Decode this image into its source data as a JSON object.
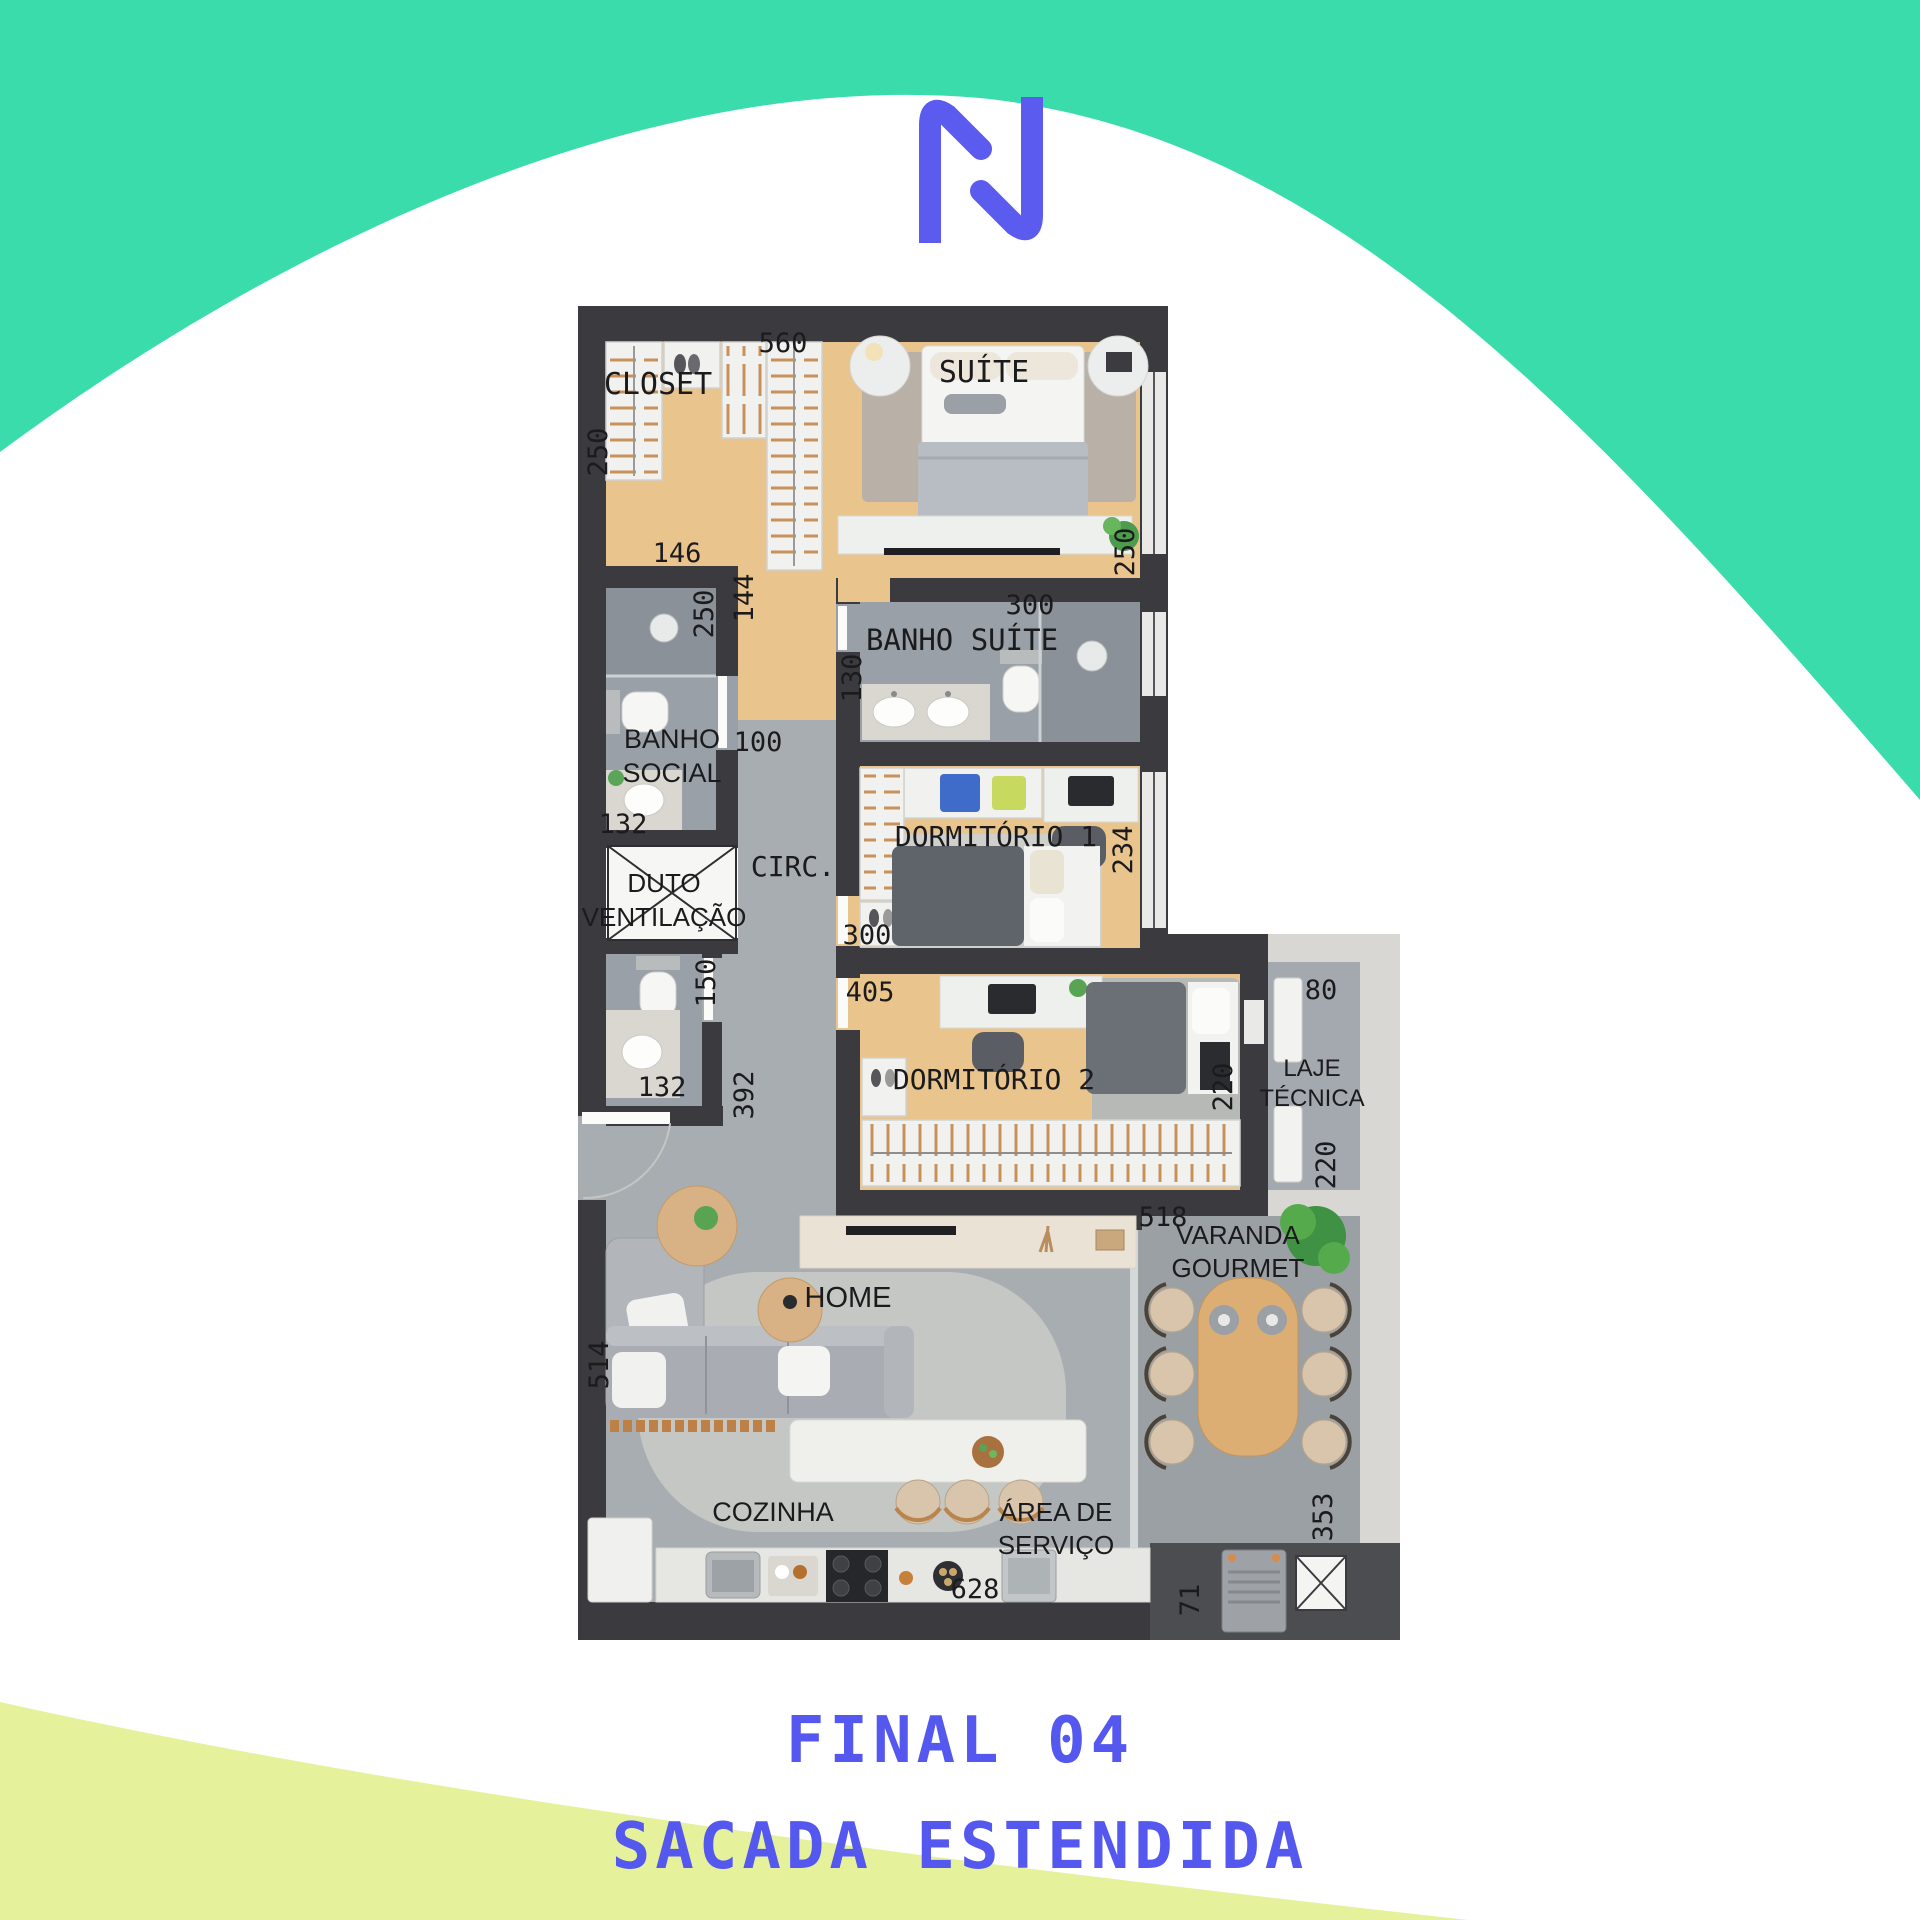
{
  "colors": {
    "teal_wave": "#3bdcab",
    "lime_wave": "#e6f19b",
    "accent_blue": "#5558ef",
    "wall": "#3b3b3f",
    "wood_floor": "#e9c48c",
    "tile_floor": "#a8adb2",
    "bath_floor": "#99a0a7",
    "varanda_floor": "#9ba0a5",
    "concrete": "#d8d7d3"
  },
  "logo": {
    "name": "N monogram",
    "color": "#5b5bef"
  },
  "footer": {
    "line1": "FINAL 04",
    "line2": "SACADA ESTENDIDA",
    "color": "#5558ef"
  },
  "plan": {
    "room_labels": [
      {
        "text": "CLOSET",
        "x": 658,
        "y": 394,
        "size": 30,
        "font": "mono"
      },
      {
        "text": "SUÍTE",
        "x": 984,
        "y": 382,
        "size": 30,
        "font": "mono"
      },
      {
        "text": "BANHO SUÍTE",
        "x": 962,
        "y": 650,
        "size": 29,
        "font": "mono"
      },
      {
        "text": "BANHO",
        "x": 672,
        "y": 748,
        "size": 27,
        "font": "sans"
      },
      {
        "text": "SOCIAL",
        "x": 672,
        "y": 782,
        "size": 27,
        "font": "sans"
      },
      {
        "text": "DUTO",
        "x": 664,
        "y": 892,
        "size": 26,
        "font": "sans"
      },
      {
        "text": "VENTILAÇÃO",
        "x": 664,
        "y": 926,
        "size": 26,
        "font": "sans"
      },
      {
        "text": "CIRC.",
        "x": 793,
        "y": 876,
        "size": 28,
        "font": "mono"
      },
      {
        "text": "DORMITÓRIO 1",
        "x": 996,
        "y": 846,
        "size": 28,
        "font": "mono"
      },
      {
        "text": "DORMITÓRIO 2",
        "x": 994,
        "y": 1089,
        "size": 28,
        "font": "mono"
      },
      {
        "text": "LAJE",
        "x": 1312,
        "y": 1076,
        "size": 24,
        "font": "sans"
      },
      {
        "text": "TÉCNICA",
        "x": 1312,
        "y": 1106,
        "size": 24,
        "font": "sans"
      },
      {
        "text": "VARANDA",
        "x": 1238,
        "y": 1244,
        "size": 26,
        "font": "sans"
      },
      {
        "text": "GOURMET",
        "x": 1238,
        "y": 1277,
        "size": 26,
        "font": "sans"
      },
      {
        "text": "HOME",
        "x": 848,
        "y": 1307,
        "size": 29,
        "font": "sans"
      },
      {
        "text": "COZINHA",
        "x": 773,
        "y": 1521,
        "size": 27,
        "font": "sans"
      },
      {
        "text": "ÁREA DE",
        "x": 1056,
        "y": 1521,
        "size": 26,
        "font": "sans"
      },
      {
        "text": "SERVIÇO",
        "x": 1056,
        "y": 1554,
        "size": 26,
        "font": "sans"
      }
    ],
    "measurements": [
      {
        "text": "560",
        "x": 783,
        "y": 352
      },
      {
        "text": "250",
        "x": 607,
        "y": 452,
        "rot": -90
      },
      {
        "text": "146",
        "x": 677,
        "y": 562
      },
      {
        "text": "144",
        "x": 753,
        "y": 598,
        "rot": -90
      },
      {
        "text": "250",
        "x": 713,
        "y": 614,
        "rot": -90
      },
      {
        "text": "250",
        "x": 1134,
        "y": 552,
        "rot": -90
      },
      {
        "text": "300",
        "x": 1030,
        "y": 614
      },
      {
        "text": "130",
        "x": 861,
        "y": 678,
        "rot": -90
      },
      {
        "text": "100",
        "x": 758,
        "y": 751
      },
      {
        "text": "132",
        "x": 623,
        "y": 833
      },
      {
        "text": "234",
        "x": 1132,
        "y": 850,
        "rot": -90
      },
      {
        "text": "150",
        "x": 715,
        "y": 983,
        "rot": -90
      },
      {
        "text": "300",
        "x": 867,
        "y": 944
      },
      {
        "text": "405",
        "x": 870,
        "y": 1001
      },
      {
        "text": "132",
        "x": 662,
        "y": 1096
      },
      {
        "text": "392",
        "x": 753,
        "y": 1095,
        "rot": -90
      },
      {
        "text": "220",
        "x": 1232,
        "y": 1087,
        "rot": -90
      },
      {
        "text": "80",
        "x": 1321,
        "y": 999
      },
      {
        "text": "220",
        "x": 1335,
        "y": 1165,
        "rot": -90
      },
      {
        "text": "518",
        "x": 1163,
        "y": 1226
      },
      {
        "text": "514",
        "x": 608,
        "y": 1365,
        "rot": -90
      },
      {
        "text": "353",
        "x": 1332,
        "y": 1517,
        "rot": -90
      },
      {
        "text": "628",
        "x": 975,
        "y": 1598
      },
      {
        "text": "71",
        "x": 1199,
        "y": 1600,
        "rot": -90
      }
    ]
  }
}
